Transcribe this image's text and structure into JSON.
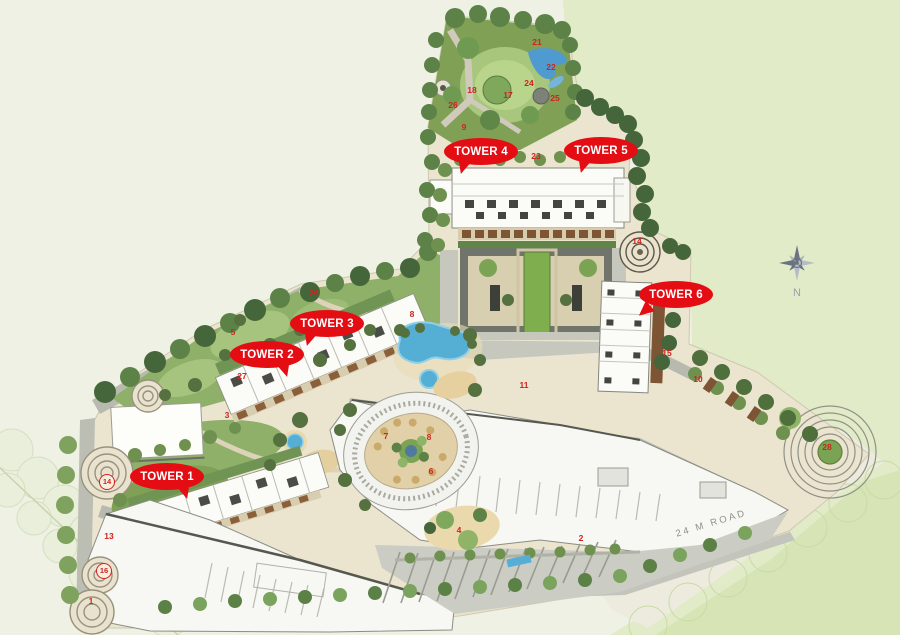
{
  "towers": [
    {
      "label": "TOWER 1"
    },
    {
      "label": "TOWER 2"
    },
    {
      "label": "TOWER 3"
    },
    {
      "label": "TOWER 4"
    },
    {
      "label": "TOWER 5"
    },
    {
      "label": "TOWER 6"
    }
  ],
  "markers": [
    {
      "label": "21"
    },
    {
      "label": "22"
    },
    {
      "label": "24"
    },
    {
      "label": "25"
    },
    {
      "label": "17"
    },
    {
      "label": "18"
    },
    {
      "label": "26"
    },
    {
      "label": "9"
    },
    {
      "label": "23"
    },
    {
      "label": "14"
    },
    {
      "label": "26"
    },
    {
      "label": "5"
    },
    {
      "label": "8"
    },
    {
      "label": "27"
    },
    {
      "label": "3"
    },
    {
      "label": "7"
    },
    {
      "label": "8"
    },
    {
      "label": "6"
    },
    {
      "label": "11"
    },
    {
      "label": "15"
    },
    {
      "label": "10"
    },
    {
      "label": "28"
    },
    {
      "label": "14"
    },
    {
      "label": "13"
    },
    {
      "label": "16"
    },
    {
      "label": "1"
    },
    {
      "label": "4"
    },
    {
      "label": "2"
    }
  ],
  "compass": {
    "north_label": "N"
  },
  "road": {
    "label": "24 M ROAD"
  },
  "colors": {
    "badge-red": "#e40d13",
    "marker-red": "#cf231c",
    "water-blue": "#57aed4",
    "lawn-green": "#a6c47e",
    "tree-dark": "#4c6c3a",
    "road-gray": "#b8bab0",
    "compass-gray": "#6b7280"
  }
}
